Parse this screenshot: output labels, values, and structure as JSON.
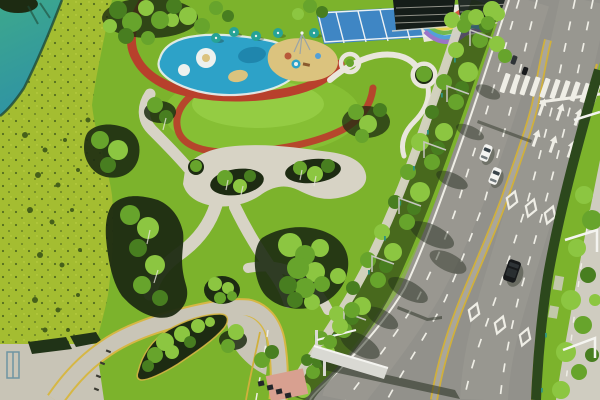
{
  "scene": {
    "description": "Aerial drone view of a landscaped city park with splash-pool playground beside a curved multi-lane arterial road",
    "time_of_day": "daytime",
    "visible_text": "none",
    "inventory": {
      "vehicles": {
        "white_cars_left_carriageway": 2,
        "dark_suv_right_carriageway": 1,
        "distant_small_cars_top": 2
      },
      "road_markings": [
        "dashed white lane lines",
        "solid white edge line",
        "yellow edge lines",
        "yellow median lines",
        "white diamond symbols x6",
        "straight lane arrows x6",
        "zebra crosswalk",
        "stop line"
      ],
      "structures": [
        "overhead sign gantry with long shadow",
        "pink-roof kiosk",
        "concrete ramp plaza",
        "street lamps",
        "green bollards along greenway"
      ],
      "park_features": [
        "teal lake corner",
        "speckled meadow slope",
        "blue splash pool with white circles",
        "sand play area",
        "teal canopies x5",
        "red play track",
        "multicolor sports courts",
        "lawn hill",
        "winding concrete paths",
        "tree planting islands",
        "teardrop shrub island",
        "yellow-curbed access road"
      ]
    }
  },
  "colors": {
    "lakeTop": "#3da88c",
    "lakeBottom": "#2f93a4",
    "shoreline": "#1f4a38",
    "meadow": "#a4bd31",
    "meadowBright": "#c2d44a",
    "meadowSpeckle": "#46601c",
    "meadowShrub": "#3c5618",
    "parkLawn": "#7cb32c",
    "lawnHill": "#86bf34",
    "lawnHighlight": "#9ad14a",
    "treeBright": "#8cc641",
    "treeMid": "#67a42c",
    "treeDark": "#487e20",
    "shadowBed": "#1d2b12",
    "path": "#d7d3c5",
    "pathBright": "#e9e6dc",
    "parkRoad": "#c9c5b7",
    "curbYellow": "#d6b744",
    "tickDark": "#3a3a32",
    "track": "#b8402c",
    "poolBlue": "#2da2c8",
    "poolDeep": "#1f86ad",
    "poolWhite": "#edf1ee",
    "sand": "#dbc37e",
    "umbrella": "#27a396",
    "equipRed": "#b8593a",
    "equipBrown": "#8a5a2e",
    "equipPole": "#9aa4a8",
    "courtBlue": "#3f86c4",
    "courtLine": "#eef2f4",
    "rainbowBg": "#e9e6dc",
    "rainbow1": "#d85a42",
    "rainbow2": "#e69a3c",
    "rainbow3": "#e8d44e",
    "rainbow4": "#72b84e",
    "rainbow5": "#52a0d8",
    "rainbow6": "#9a74c8",
    "building1": "#151d19",
    "building2": "#232c27",
    "buildingEdge": "#e2ded2",
    "asphalt": "#92918b",
    "asphaltLight": "#a6a49c",
    "laneWhite": "#efeee6",
    "laneYellow": "#d0b03c",
    "medianPave": "#a9a69c",
    "roadShadow": "#252d1f",
    "carWhite": "#f4f4f1",
    "carGlass": "#39444a",
    "carDark": "#17191b",
    "carDarkRoof": "#2e3336",
    "gantry": "#d9d9d3",
    "gantryBright": "#f4f4f0",
    "pole": "#c6c6c0",
    "bollard": "#2e9380",
    "hedge": "#2c481c",
    "sidewalk": "#cfccc0",
    "ramp": "#c8c4b6",
    "wall": "#203317",
    "railing": "#6e94a2",
    "kioskPink": "#d8a090",
    "kioskDark": "#23262a"
  }
}
